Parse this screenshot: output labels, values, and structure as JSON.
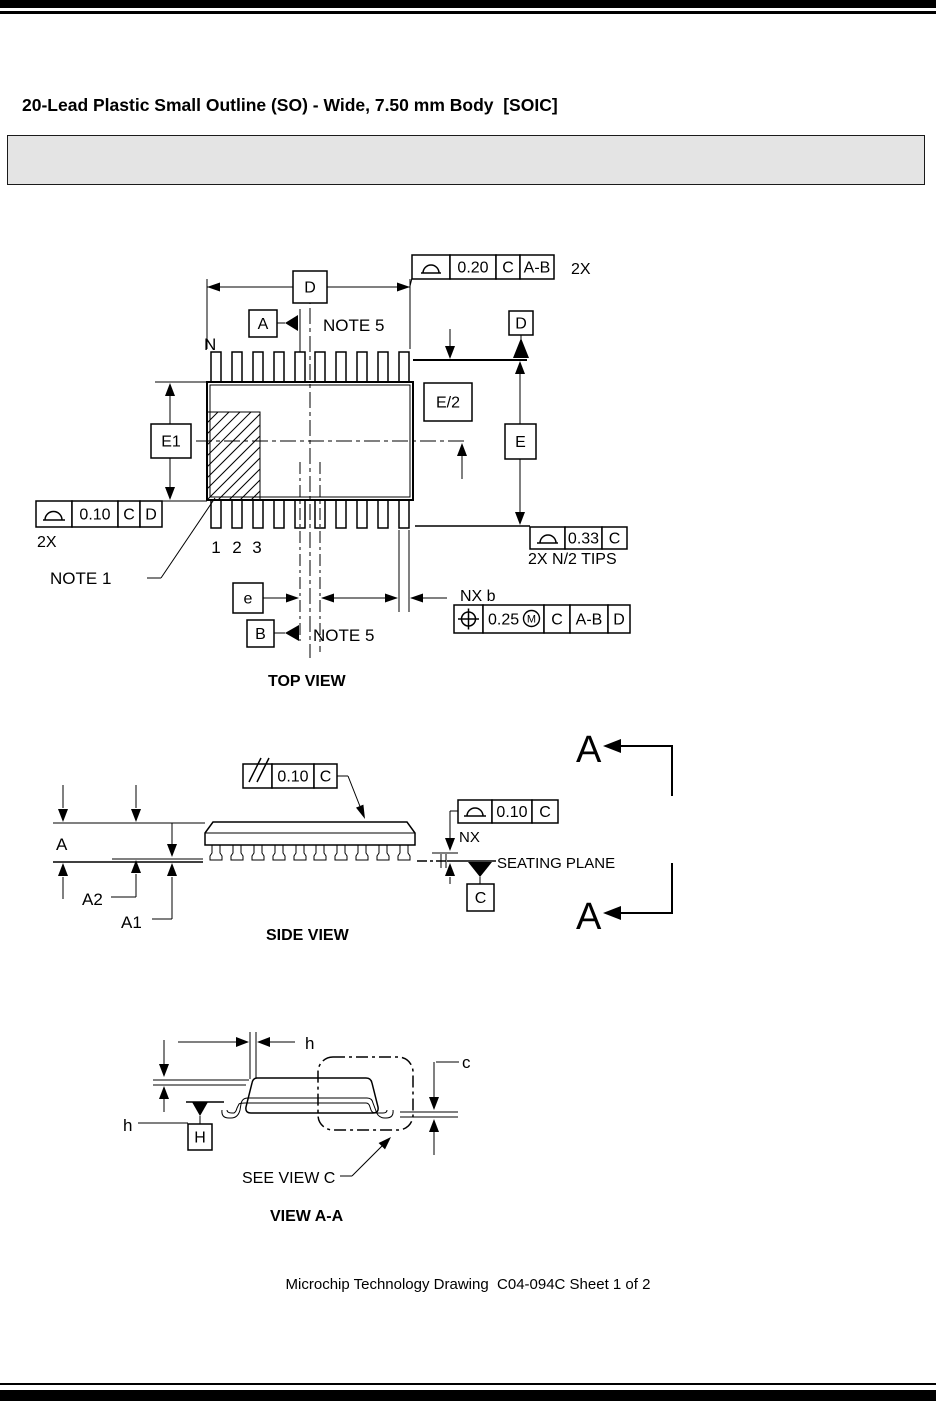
{
  "page": {
    "title": "20-Lead Plastic Small Outline (SO) - Wide, 7.50 mm Body  [SOIC]",
    "footer": "Microchip Technology Drawing  C04-094C Sheet 1 of 2"
  },
  "colors": {
    "ink": "#000000",
    "note_box_fill": "#e4e4e4"
  },
  "top_view": {
    "caption": "TOP VIEW",
    "lead_count_label": "N",
    "pin_numbers": [
      "1",
      "2",
      "3"
    ],
    "dim_D": "D",
    "dim_E1": "E1",
    "dim_E": "E",
    "dim_E_half": "E/2",
    "dim_e": "e",
    "dim_b": "NX b",
    "datum_A": "A",
    "datum_B": "B",
    "datum_D": "D",
    "note5_top": "NOTE 5",
    "note5_bottom": "NOTE 5",
    "note1": "NOTE 1",
    "qty_top": "2X",
    "qty_left": "2X",
    "qty_tips": "2X N/2 TIPS",
    "fcf_top": {
      "tol": "0.20",
      "ref1": "C",
      "ref2": "A-B"
    },
    "fcf_left": {
      "tol": "0.10",
      "ref1": "C",
      "ref2": "D"
    },
    "fcf_tips": {
      "tol": "0.33",
      "ref1": "C"
    },
    "fcf_position": {
      "tol": "0.25",
      "modifier": "M",
      "ref1": "C",
      "ref2": "A-B",
      "ref3": "D"
    }
  },
  "side_view": {
    "caption": "SIDE VIEW",
    "dim_A": "A",
    "dim_A1": "A1",
    "dim_A2": "A2",
    "fcf_parallelism": {
      "tol": "0.10",
      "ref1": "C"
    },
    "fcf_profile": {
      "tol": "0.10",
      "ref1": "C"
    },
    "nx_label": "NX",
    "seating_plane": "SEATING PLANE",
    "datum_C": "C",
    "section_label_top": "A",
    "section_label_bottom": "A"
  },
  "view_aa": {
    "caption": "VIEW A-A",
    "dim_h_top": "h",
    "dim_h_left": "h",
    "dim_c": "c",
    "datum_H": "H",
    "see_view_c": "SEE VIEW C"
  }
}
